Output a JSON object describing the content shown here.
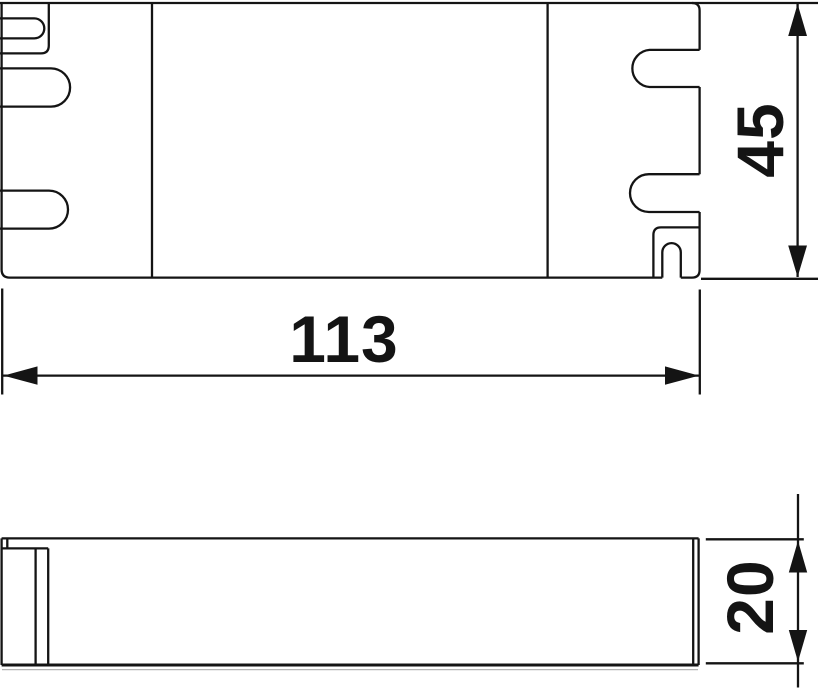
{
  "drawing": {
    "kind": "technical-dimension-drawing",
    "views": {
      "top_view": "enclosure top view with cable entry slots",
      "side_view": "enclosure side profile view"
    },
    "dimensions": {
      "length": "113",
      "height": "45",
      "depth": "20"
    },
    "colors": {
      "line": "#141414",
      "background": "#ffffff"
    }
  }
}
